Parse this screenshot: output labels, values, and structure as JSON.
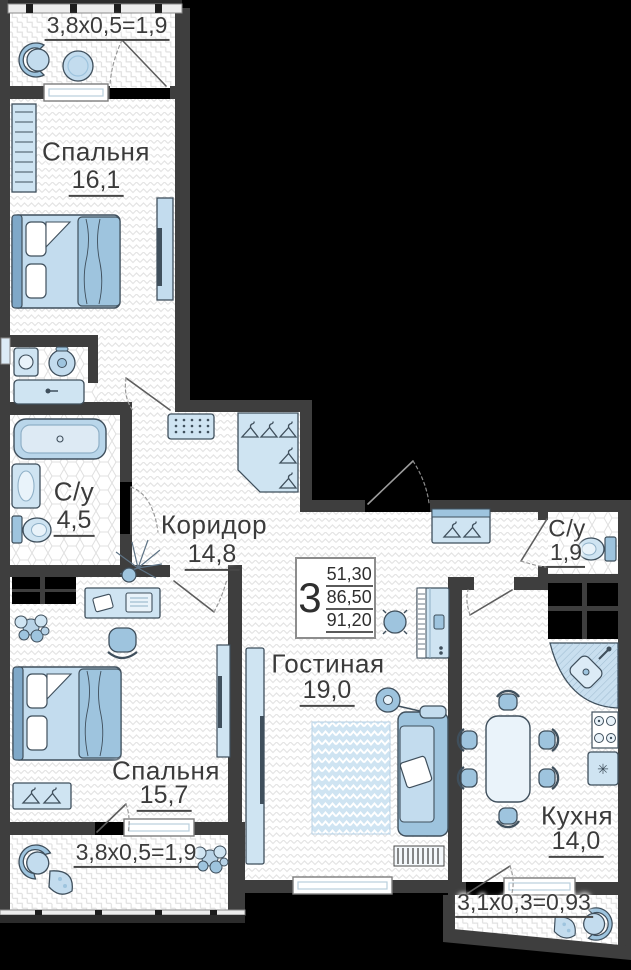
{
  "rooms": {
    "bedroom1": {
      "name": "Спальня",
      "area": "16,1"
    },
    "bathroom1": {
      "name": "С/у",
      "area": "4,5"
    },
    "corridor": {
      "name": "Коридор",
      "area": "14,8"
    },
    "bathroom2": {
      "name": "С/у",
      "area": "1,9"
    },
    "living": {
      "name": "Гостиная",
      "area": "19,0"
    },
    "bedroom2": {
      "name": "Спальня",
      "area": "15,7"
    },
    "kitchen": {
      "name": "Кухня",
      "area": "14,0"
    }
  },
  "balconies": {
    "top": {
      "label": "3,8x0,5=1,9"
    },
    "bottom_left": {
      "label": "3,8x0,5=1,9"
    },
    "bottom_right": {
      "label": "3,1x0,3=0,93"
    }
  },
  "summary": {
    "rooms_count": "3",
    "areas": [
      "51,30",
      "86,50",
      "91,20"
    ]
  },
  "icons": {
    "fridge_snowflake": "✳"
  },
  "colors": {
    "wall": "#3e3e3e",
    "outside": "#000000",
    "floor": "#ffffff",
    "furniture_light": "#c3dcee",
    "furniture_mid": "#9ec4de",
    "outline_dark": "#3f4f5c",
    "text": "#3b3b3b"
  }
}
